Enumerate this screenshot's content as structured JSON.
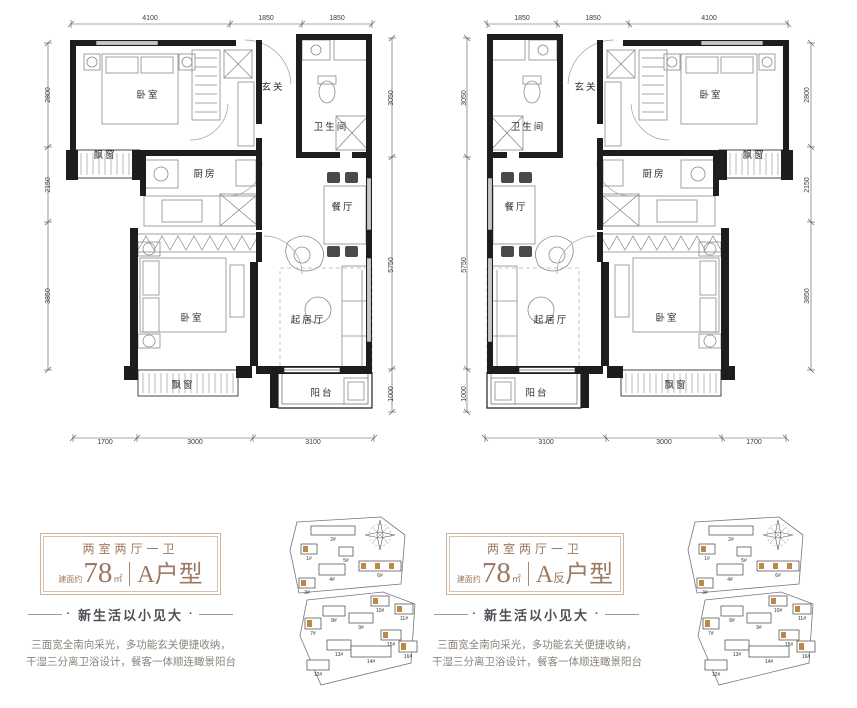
{
  "page": {
    "background": "#ffffff"
  },
  "floorplan": {
    "wall_color": "#1d1d1d",
    "rooms": [
      {
        "t": "卧室",
        "x": 108,
        "y": 88
      },
      {
        "t": "玄关",
        "x": 233,
        "y": 80
      },
      {
        "t": "卫生间",
        "x": 291,
        "y": 120
      },
      {
        "t": "飘窗",
        "x": 65,
        "y": 148
      },
      {
        "t": "厨房",
        "x": 165,
        "y": 167
      },
      {
        "t": "餐厅",
        "x": 303,
        "y": 200
      },
      {
        "t": "卧室",
        "x": 152,
        "y": 311
      },
      {
        "t": "起居厅",
        "x": 268,
        "y": 313
      },
      {
        "t": "飘窗",
        "x": 143,
        "y": 378
      },
      {
        "t": "阳台",
        "x": 282,
        "y": 386
      }
    ],
    "dims": [
      {
        "v": "4100",
        "x": 110,
        "y": 10,
        "rot": false
      },
      {
        "v": "1850",
        "x": 226,
        "y": 10,
        "rot": false
      },
      {
        "v": "1850",
        "x": 297,
        "y": 10,
        "rot": false
      },
      {
        "v": "2800",
        "x": 10,
        "y": 85,
        "rot": true
      },
      {
        "v": "2150",
        "x": 10,
        "y": 175,
        "rot": true
      },
      {
        "v": "3850",
        "x": 10,
        "y": 286,
        "rot": true
      },
      {
        "v": "3050",
        "x": 353,
        "y": 88,
        "rot": true
      },
      {
        "v": "5750",
        "x": 353,
        "y": 255,
        "rot": true
      },
      {
        "v": "1000",
        "x": 353,
        "y": 384,
        "rot": true
      },
      {
        "v": "1700",
        "x": 65,
        "y": 434,
        "rot": false
      },
      {
        "v": "3000",
        "x": 155,
        "y": 434,
        "rot": false
      },
      {
        "v": "3100",
        "x": 273,
        "y": 434,
        "rot": false
      }
    ]
  },
  "cards": [
    {
      "config": "两室两厅一卫",
      "area_label": "建面约",
      "area_value": "78",
      "area_unit": "㎡",
      "unit_main": "A",
      "unit_sub": "",
      "unit_rest": "户型",
      "tagline": "新生活以小见大",
      "dot": "·",
      "desc_line1": "三面宽全南向采光，多功能玄关便捷收纳，",
      "desc_line2": "干湿三分离卫浴设计，餐客一体顺连瞰景阳台"
    },
    {
      "config": "两室两厅一卫",
      "area_label": "建面约",
      "area_value": "78",
      "area_unit": "㎡",
      "unit_main": "A",
      "unit_sub": "反",
      "unit_rest": "户型",
      "tagline": "新生活以小见大",
      "dot": "·",
      "desc_line1": "三面宽全南向采光，多功能玄关便捷收纳，",
      "desc_line2": "干湿三分离卫浴设计，餐客一体顺连瞰景阳台"
    }
  ],
  "siteplan": {
    "highlight_color": "#bd8747",
    "buildings": [
      {
        "label": "2#",
        "x": 28,
        "y": 12,
        "w": 44,
        "h": 9,
        "hl": false,
        "marks": 0
      },
      {
        "label": "1#",
        "x": 18,
        "y": 30,
        "w": 16,
        "h": 10,
        "hl": true,
        "marks": 1
      },
      {
        "label": "5#",
        "x": 56,
        "y": 33,
        "w": 14,
        "h": 9,
        "hl": false,
        "marks": 0
      },
      {
        "label": "4#",
        "x": 36,
        "y": 50,
        "w": 26,
        "h": 11,
        "hl": false,
        "marks": 0
      },
      {
        "label": "6#",
        "x": 76,
        "y": 47,
        "w": 42,
        "h": 10,
        "hl": true,
        "marks": 3
      },
      {
        "label": "3#",
        "x": 16,
        "y": 64,
        "w": 16,
        "h": 10,
        "hl": true,
        "marks": 1
      },
      {
        "label": "10#",
        "x": 88,
        "y": 82,
        "w": 18,
        "h": 10,
        "hl": true,
        "marks": 1
      },
      {
        "label": "11#",
        "x": 112,
        "y": 90,
        "w": 18,
        "h": 10,
        "hl": true,
        "marks": 1
      },
      {
        "label": "8#",
        "x": 40,
        "y": 92,
        "w": 22,
        "h": 10,
        "hl": false,
        "marks": 0
      },
      {
        "label": "9#",
        "x": 66,
        "y": 99,
        "w": 24,
        "h": 10,
        "hl": false,
        "marks": 0
      },
      {
        "label": "7#",
        "x": 22,
        "y": 104,
        "w": 16,
        "h": 11,
        "hl": true,
        "marks": 1
      },
      {
        "label": "15#",
        "x": 98,
        "y": 116,
        "w": 20,
        "h": 10,
        "hl": true,
        "marks": 1
      },
      {
        "label": "13#",
        "x": 44,
        "y": 126,
        "w": 24,
        "h": 10,
        "hl": false,
        "marks": 0
      },
      {
        "label": "14#",
        "x": 68,
        "y": 132,
        "w": 40,
        "h": 11,
        "hl": false,
        "marks": 0
      },
      {
        "label": "16#",
        "x": 116,
        "y": 127,
        "w": 18,
        "h": 11,
        "hl": true,
        "marks": 1
      },
      {
        "label": "12#",
        "x": 24,
        "y": 146,
        "w": 22,
        "h": 10,
        "hl": false,
        "marks": 0
      }
    ]
  }
}
